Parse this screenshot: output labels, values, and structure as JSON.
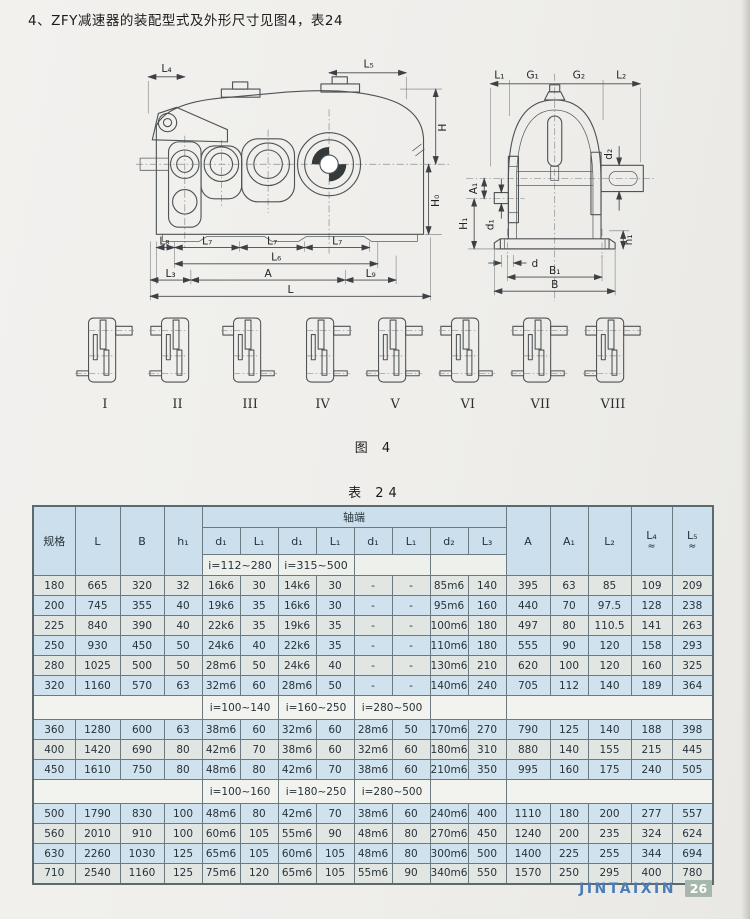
{
  "page": {
    "title": "4、ZFY减速器的装配型式及外形尺寸见图4，表24",
    "figure_caption": "图 4",
    "table_caption": "表 24",
    "footer": {
      "brand": "JINTAIXIN",
      "page_number": "26"
    }
  },
  "colors": {
    "header_bg": "#cbdfec",
    "row_blue": "#cfe2ee",
    "row_gray": "#e2e6e2",
    "band_bg": "#f2f3ee",
    "brand_blue": "#4a7db8",
    "badge_bg": "#a6b7ab"
  },
  "figure": {
    "side_view": {
      "L4": "L₄",
      "L5": "L₅",
      "H": "H",
      "H0": "H₀",
      "L8": "L₈",
      "L7": "L₇",
      "L6": "L₆",
      "L3": "L₃",
      "A": "A",
      "L9": "L₉",
      "L": "L"
    },
    "end_view": {
      "L1": "L₁",
      "G1": "G₁",
      "G2": "G₂",
      "L2": "L₂",
      "d2": "d₂",
      "A1": "A₁",
      "H1": "H₁",
      "d1": "d₁",
      "h1": "h₁",
      "d": "d",
      "B1": "B₁",
      "B": "B"
    },
    "variants": [
      {
        "numeral": "I",
        "stubs": {
          "tl": false,
          "tr": true,
          "bl": true,
          "br": false
        }
      },
      {
        "numeral": "II",
        "stubs": {
          "tl": true,
          "tr": false,
          "bl": true,
          "br": false
        }
      },
      {
        "numeral": "III",
        "stubs": {
          "tl": true,
          "tr": false,
          "bl": false,
          "br": true
        }
      },
      {
        "numeral": "IV",
        "stubs": {
          "tl": false,
          "tr": true,
          "bl": false,
          "br": true
        }
      },
      {
        "numeral": "V",
        "stubs": {
          "tl": false,
          "tr": true,
          "bl": true,
          "br": true
        }
      },
      {
        "numeral": "VI",
        "stubs": {
          "tl": true,
          "tr": false,
          "bl": true,
          "br": true
        }
      },
      {
        "numeral": "VII",
        "stubs": {
          "tl": true,
          "tr": true,
          "bl": true,
          "br": true
        }
      },
      {
        "numeral": "VIII",
        "stubs": {
          "tl": true,
          "tr": true,
          "bl": true,
          "br": false
        }
      }
    ]
  },
  "table": {
    "headers": {
      "spec": "规格",
      "L": "L",
      "B": "B",
      "h1": "h₁",
      "shaft_group": "轴端",
      "d1": "d₁",
      "L1": "L₁",
      "d2": "d₂",
      "L3": "L₃",
      "range_a": "i=112~280",
      "range_b": "i=315~500",
      "A": "A",
      "A1": "A₁",
      "L2": "L₂",
      "L4": "L₄",
      "L5": "L₅",
      "approx": "≈"
    },
    "groups": [
      {
        "band": null,
        "rows": [
          {
            "spec": "180",
            "shade": "gray",
            "values": [
              "665",
              "320",
              "32",
              "16k6",
              "30",
              "14k6",
              "30",
              "-",
              "-",
              "85m6",
              "140",
              "395",
              "63",
              "85",
              "109",
              "209"
            ]
          },
          {
            "spec": "200",
            "shade": "blue",
            "values": [
              "745",
              "355",
              "40",
              "19k6",
              "35",
              "16k6",
              "30",
              "-",
              "-",
              "95m6",
              "160",
              "440",
              "70",
              "97.5",
              "128",
              "238"
            ]
          },
          {
            "spec": "225",
            "shade": "gray",
            "values": [
              "840",
              "390",
              "40",
              "22k6",
              "35",
              "19k6",
              "35",
              "-",
              "-",
              "100m6",
              "180",
              "497",
              "80",
              "110.5",
              "141",
              "263"
            ]
          },
          {
            "spec": "250",
            "shade": "blue",
            "values": [
              "930",
              "450",
              "50",
              "24k6",
              "40",
              "22k6",
              "35",
              "-",
              "-",
              "110m6",
              "180",
              "555",
              "90",
              "120",
              "158",
              "293"
            ]
          },
          {
            "spec": "280",
            "shade": "gray",
            "values": [
              "1025",
              "500",
              "50",
              "28m6",
              "50",
              "24k6",
              "40",
              "-",
              "-",
              "130m6",
              "210",
              "620",
              "100",
              "120",
              "160",
              "325"
            ]
          },
          {
            "spec": "320",
            "shade": "blue",
            "values": [
              "1160",
              "570",
              "63",
              "32m6",
              "60",
              "28m6",
              "50",
              "-",
              "-",
              "140m6",
              "240",
              "705",
              "112",
              "140",
              "189",
              "364"
            ]
          }
        ]
      },
      {
        "band": [
          "i=100~140",
          "i=160~250",
          "i=280~500"
        ],
        "rows": [
          {
            "spec": "360",
            "shade": "blue",
            "values": [
              "1280",
              "600",
              "63",
              "38m6",
              "60",
              "32m6",
              "60",
              "28m6",
              "50",
              "170m6",
              "270",
              "790",
              "125",
              "140",
              "188",
              "398"
            ]
          },
          {
            "spec": "400",
            "shade": "gray",
            "values": [
              "1420",
              "690",
              "80",
              "42m6",
              "70",
              "38m6",
              "60",
              "32m6",
              "60",
              "180m6",
              "310",
              "880",
              "140",
              "155",
              "215",
              "445"
            ]
          },
          {
            "spec": "450",
            "shade": "blue",
            "values": [
              "1610",
              "750",
              "80",
              "48m6",
              "80",
              "42m6",
              "70",
              "38m6",
              "60",
              "210m6",
              "350",
              "995",
              "160",
              "175",
              "240",
              "505"
            ]
          }
        ]
      },
      {
        "band": [
          "i=100~160",
          "i=180~250",
          "i=280~500"
        ],
        "rows": [
          {
            "spec": "500",
            "shade": "blue",
            "values": [
              "1790",
              "830",
              "100",
              "48m6",
              "80",
              "42m6",
              "70",
              "38m6",
              "60",
              "240m6",
              "400",
              "1110",
              "180",
              "200",
              "277",
              "557"
            ]
          },
          {
            "spec": "560",
            "shade": "gray",
            "values": [
              "2010",
              "910",
              "100",
              "60m6",
              "105",
              "55m6",
              "90",
              "48m6",
              "80",
              "270m6",
              "450",
              "1240",
              "200",
              "235",
              "324",
              "624"
            ]
          },
          {
            "spec": "630",
            "shade": "blue",
            "values": [
              "2260",
              "1030",
              "125",
              "65m6",
              "105",
              "60m6",
              "105",
              "48m6",
              "80",
              "300m6",
              "500",
              "1400",
              "225",
              "255",
              "344",
              "694"
            ]
          },
          {
            "spec": "710",
            "shade": "gray",
            "values": [
              "2540",
              "1160",
              "125",
              "75m6",
              "120",
              "65m6",
              "105",
              "55m6",
              "90",
              "340m6",
              "550",
              "1570",
              "250",
              "295",
              "400",
              "780"
            ]
          }
        ]
      }
    ]
  }
}
